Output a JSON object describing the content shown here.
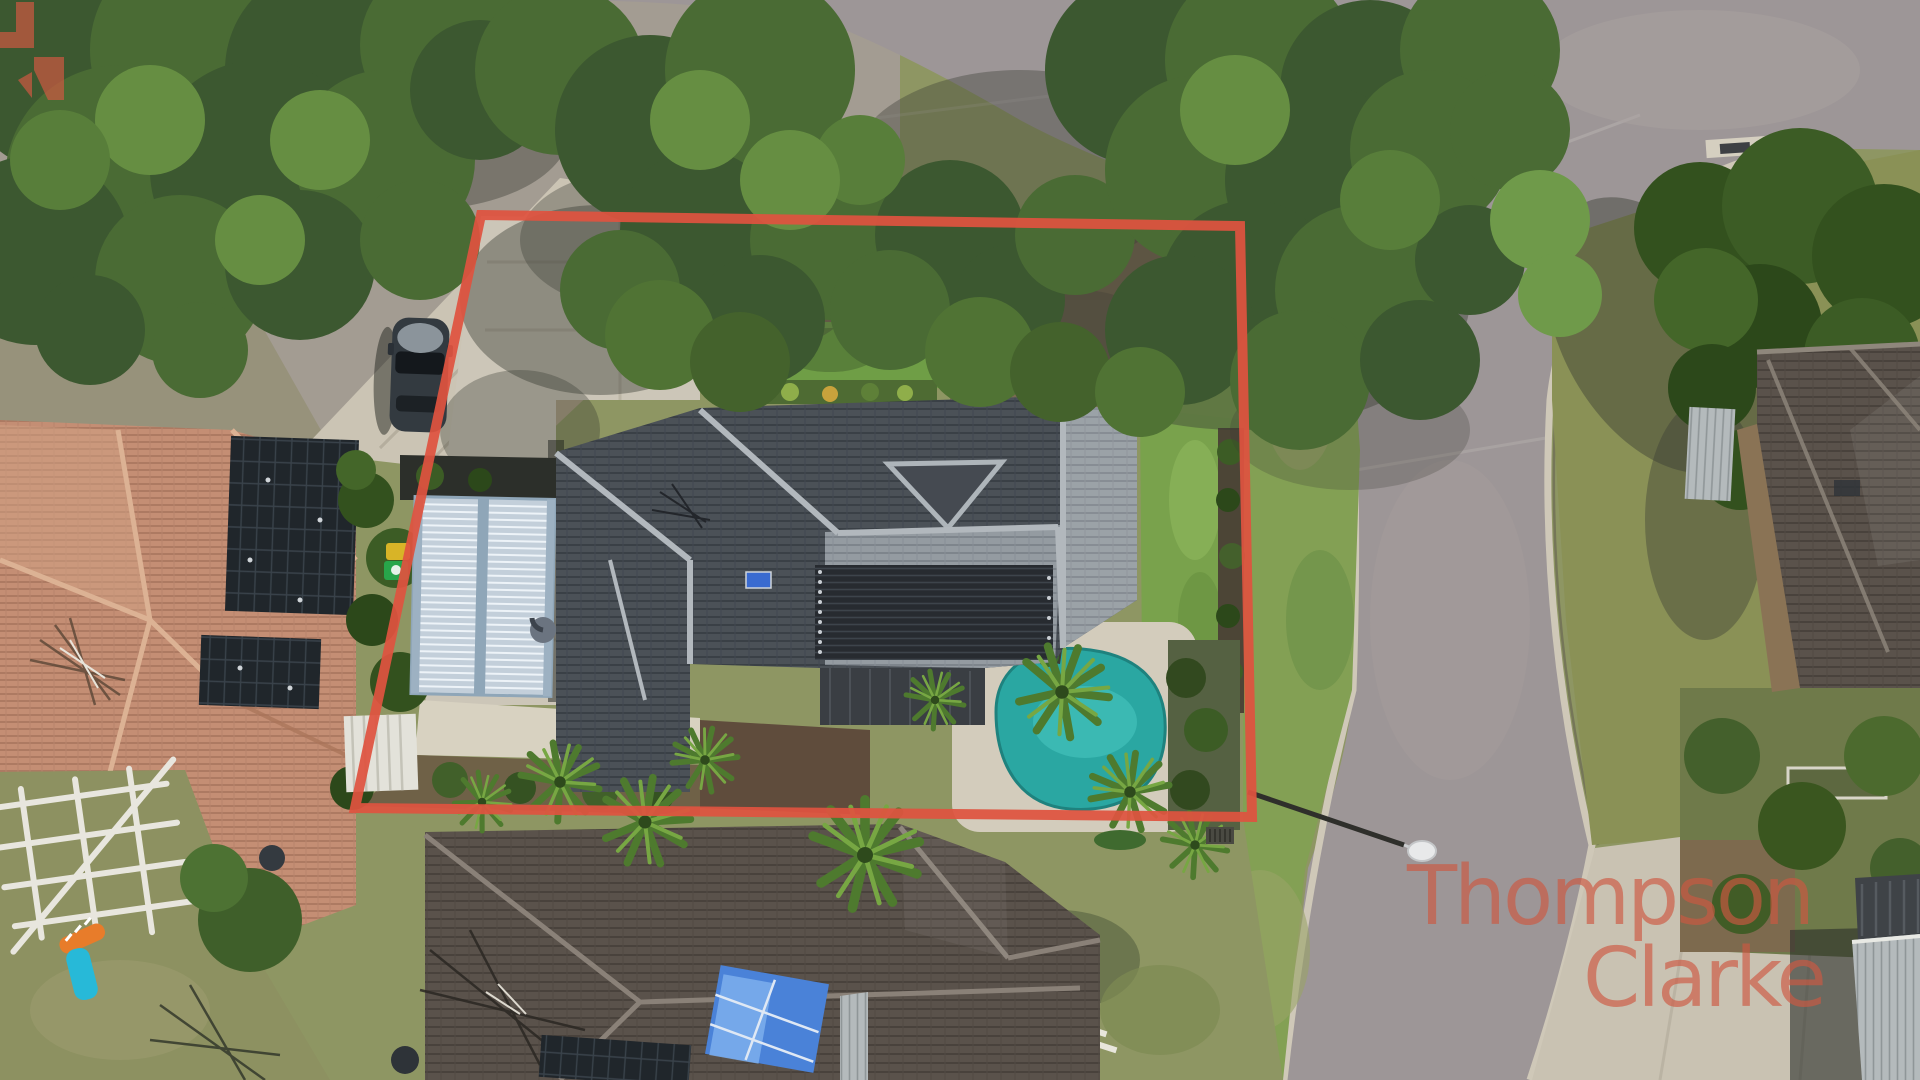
{
  "photo": {
    "kind": "aerial-drone-real-estate-photo",
    "view": "top-down suburban block, daytime",
    "width_px": 1920,
    "height_px": 1080
  },
  "watermark": {
    "line1": "Thompson",
    "line2": "Clarke",
    "text_color": "rgba(205,88,66,0.66)",
    "logo_fill": "rgba(205,88,66,0.70)"
  },
  "boundary_overlay": {
    "color": "#df5340",
    "stroke_width": 10,
    "corners": {
      "top_left": [
        481,
        215
      ],
      "top_right": [
        1240,
        226
      ],
      "bottom_right": [
        1252,
        817
      ],
      "bottom_left": [
        355,
        808
      ]
    }
  },
  "palette": {
    "road_asphalt": "#9d9697",
    "concrete": "#cbc4b4",
    "nature_strip_grass": "#83a054",
    "lawn_green": "#6f9e46",
    "dry_grass": "#8e9663",
    "tree_dark": "#3c5830",
    "tree_mid": "#4a6b34",
    "tree_light": "#668e42",
    "subject_roof_dark": "#4b5157",
    "subject_roof_light": "#949ba1",
    "pool_water": "#2aa7a2",
    "garage_roof_blue": "#c3cfda",
    "terracotta_roof": "#c48e74",
    "solar_panel_dark": "#20262b",
    "solar_panel_blue": "#4a82d8",
    "bottom_roof_brown": "#5a524b",
    "car_body": "#333a40"
  },
  "scene_elements": [
    "eucalyptus-canopy",
    "asphalt-road",
    "curbs",
    "concrete-driveways",
    "parked-car",
    "subject-house-roof",
    "pool",
    "pool-solar-collector",
    "blue-garage-roof",
    "terracotta-neighbour-roof",
    "rooftop-solar-array",
    "bottom-neighbour-roof",
    "blue-solar-panels",
    "right-neighbour-roof",
    "street-light",
    "storm-grate",
    "palm-trees",
    "lawns",
    "garden-beds",
    "kids-slide",
    "pergola-frame",
    "satellite-dishes",
    "wheelie-bins",
    "hedges",
    "agency-watermark"
  ]
}
